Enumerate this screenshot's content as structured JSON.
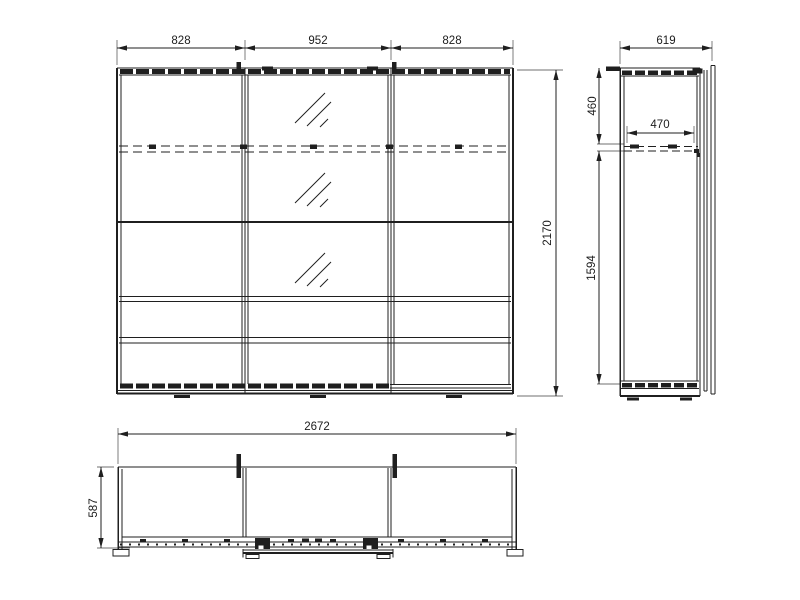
{
  "views": {
    "front": {
      "dim_left_door_width": "828",
      "dim_middle_door_width": "952",
      "dim_right_door_width": "828",
      "dim_total_height": "2170"
    },
    "side": {
      "dim_total_depth": "619",
      "dim_top_section_height": "460",
      "dim_interior_shelf_depth": "470",
      "dim_bottom_section_height": "1594"
    },
    "plan": {
      "dim_total_width": "2672",
      "dim_total_depth": "587"
    }
  },
  "colors": {
    "background": "#ffffff",
    "line": "#1f1f1f",
    "extension_line": "#6f6f6f"
  }
}
